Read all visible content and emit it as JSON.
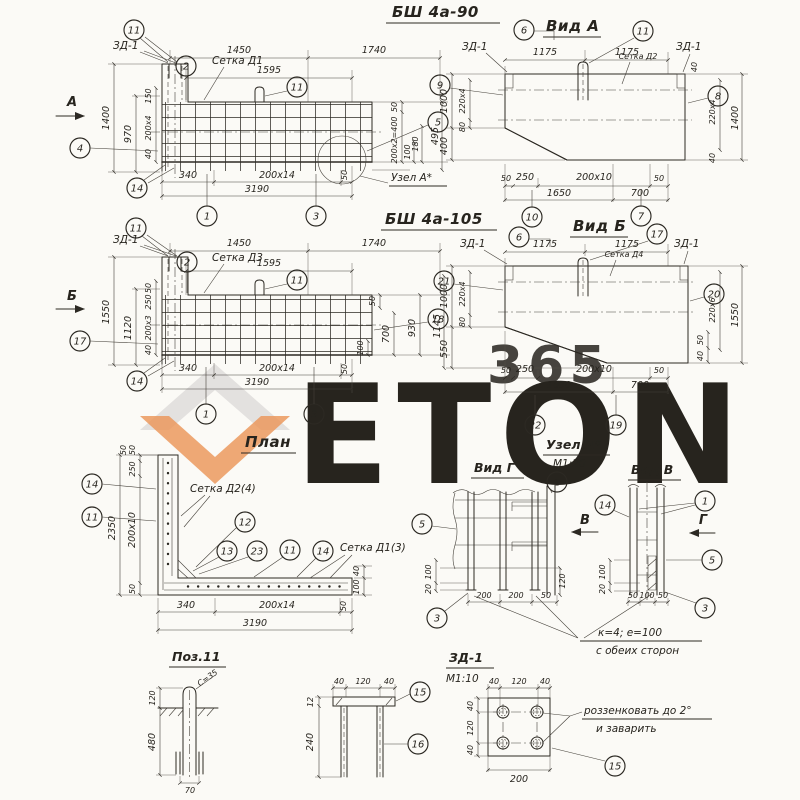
{
  "wm": {
    "brand": "ETON",
    "num": "365",
    "orange": "#eb8f4b",
    "gray": "#e2e1de"
  },
  "d1": {
    "title": "БШ 4а-90",
    "zd1": "ЗД-1",
    "setka": "Сетка Д1",
    "uzel": "Узел А*",
    "sec": "А",
    "dims": {
      "w1": "1450",
      "w2": "1740",
      "w3": "1595",
      "h1": "1400",
      "h2": "970",
      "h3": "150",
      "h4": "200х4",
      "h5": "40",
      "r1": "50",
      "r2": "200х2=400",
      "r3": "100",
      "r4": "180",
      "r5": "495",
      "r6": "50",
      "b1": "340",
      "b2": "200х14",
      "b3": "3190"
    },
    "bal": {
      "b11a": "11",
      "b2": "2",
      "b11b": "11",
      "b4": "4",
      "b14": "14",
      "b1": "1",
      "b3": "3",
      "b5": "5"
    }
  },
  "d2": {
    "title": "Вид А",
    "zd1l": "ЗД-1",
    "zd1r": "ЗД-1",
    "setka": "Сетка Д2",
    "dims": {
      "w1": "1175",
      "w2": "1175",
      "l1": "1000",
      "l2": "220х4",
      "l3": "80",
      "l4": "400",
      "r1": "1400",
      "r2": "220х4",
      "r3": "40",
      "r4": "40",
      "b1": "50",
      "b2": "250",
      "b3": "200х10",
      "b4": "50",
      "b5": "1650",
      "b6": "700"
    },
    "bal": {
      "b6": "6",
      "b11": "11",
      "b9": "9",
      "b8": "8",
      "b10": "10",
      "b7": "7"
    }
  },
  "d3": {
    "title": "БШ 4а-105",
    "zd1": "ЗД-1",
    "setka": "Сетка Д3",
    "sec": "Б",
    "dims": {
      "w1": "1450",
      "w2": "1740",
      "w3": "1595",
      "h1": "1550",
      "h2": "1120",
      "h3": "50",
      "h4": "250",
      "h5": "200х3",
      "h6": "40",
      "r1": "50",
      "r2": "930",
      "r3": "700",
      "r4": "100",
      "r5": "1145",
      "b1": "340",
      "b2": "200х14",
      "b3": "3190",
      "b4": "50"
    },
    "bal": {
      "b11a": "11",
      "b2": "2",
      "b11b": "11",
      "b17": "17",
      "b14": "14",
      "b1": "1",
      "b3": "3",
      "b18": "18"
    }
  },
  "d4": {
    "title": "Вид Б",
    "zd1l": "ЗД-1",
    "zd1r": "ЗД-1",
    "setka": "Сетка Д4",
    "dims": {
      "w1": "1175",
      "w2": "1175",
      "l1": "1000",
      "l2": "220х4",
      "l3": "80",
      "l4": "550",
      "r1": "1550",
      "r2": "220х6",
      "r3": "50",
      "r4": "40",
      "b1": "50",
      "b2": "250",
      "b3": "200х10",
      "b4": "50",
      "b5": "1650",
      "b6": "700"
    },
    "bal": {
      "b6": "6",
      "b17": "17",
      "b21": "21",
      "b20": "20",
      "b22": "22",
      "b19": "19"
    }
  },
  "d5": {
    "title": "План",
    "setka1": "Сетка Д2(4)",
    "setka2": "Сетка Д1(3)",
    "dims": {
      "l1": "2350",
      "l2": "50",
      "l3": "50",
      "l4": "250",
      "l5": "200х10",
      "l6": "50",
      "b1": "340",
      "b2": "200х14",
      "b3": "3190",
      "b4": "50",
      "r1": "40",
      "r2": "100"
    },
    "bal": {
      "b14a": "14",
      "b11a": "11",
      "b12": "12",
      "b13": "13",
      "b23": "23",
      "b11b": "11",
      "b14b": "14"
    }
  },
  "d6": {
    "title": "Узел А*",
    "scale": "М1:20",
    "vidg": "Вид Г",
    "vidv": "Вид В",
    "secv": "В",
    "secg": "Г",
    "note1": "к=4; е=100",
    "note2": "с обеих сторон",
    "dg": {
      "b1": "200",
      "b2": "200",
      "b3": "50",
      "l1": "100",
      "l2": "20",
      "r1": "120"
    },
    "dv": {
      "b1": "50",
      "b2": "100",
      "b3": "50",
      "l1": "100",
      "l2": "20"
    },
    "bg": {
      "b1": "1",
      "b5": "5",
      "b3": "3"
    },
    "bv": {
      "b14": "14",
      "b1": "1",
      "b5": "5",
      "b3": "3"
    }
  },
  "d7": {
    "title": "Поз.11",
    "c": "С=35",
    "dims": {
      "h1": "120",
      "h2": "480",
      "b1": "70"
    }
  },
  "d8": {
    "dims": {
      "t1": "40",
      "t2": "120",
      "t3": "40",
      "l1": "12",
      "l2": "240"
    },
    "bal": {
      "b15": "15",
      "b16": "16"
    }
  },
  "d9": {
    "title": "ЗД-1",
    "scale": "М1:10",
    "note1": "роззенковать до 2°",
    "note2": "и заварить",
    "dims": {
      "t1": "40",
      "t2": "120",
      "t3": "40",
      "l1": "40",
      "l2": "120",
      "l3": "40",
      "b1": "200"
    },
    "bal": {
      "b15": "15"
    }
  }
}
